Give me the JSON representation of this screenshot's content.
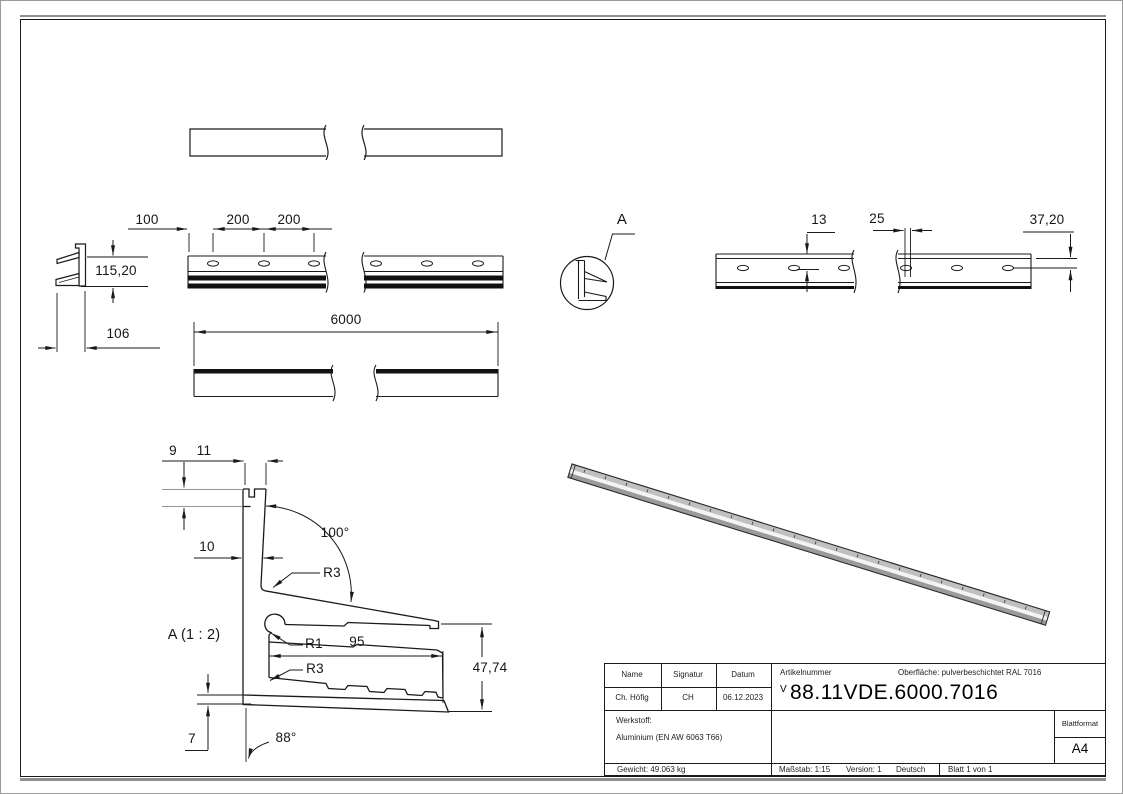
{
  "drawing": {
    "dims": {
      "d100": "100",
      "d200a": "200",
      "d200b": "200",
      "d115": "115,20",
      "d106": "106",
      "d6000": "6000",
      "d13": "13",
      "d25": "25",
      "d3720": "37,20",
      "d9": "9",
      "d11": "11",
      "d10": "10",
      "a100": "100°",
      "r3_upper": "R3",
      "r1": "R1",
      "d95": "95",
      "r3_lower": "R3",
      "d4774": "47,74",
      "d7": "7",
      "a88": "88°",
      "detail_label": "A",
      "detail_title": "A (1 : 2)"
    },
    "colors": {
      "line": "#1a1a1a",
      "extension_gray": "#949494",
      "shadow": "#8f8f8f",
      "bar3d_top": "#c0c0c0",
      "bar3d_mid": "#f4f4f4",
      "bar3d_bottom": "#9b9b9b"
    }
  },
  "title_block": {
    "name_label": "Name",
    "signatur_label": "Signatur",
    "datum_label": "Datum",
    "name_value": "Ch. Höfig",
    "signatur_value": "CH",
    "datum_value": "06.12.2023",
    "artikelnummer_label": "Artikelnummer",
    "oberflaeche": "Oberfläche:  pulverbeschichtet RAL 7016",
    "artikelnummer_prefix": "V",
    "artikelnummer_value": "88.11VDE.6000.7016",
    "werkstoff_label": "Werkstoff:",
    "werkstoff_value": "Aluminium (EN AW 6063 T66)",
    "blattformat_label": "Blattformat",
    "blattformat_value": "A4",
    "gewicht": "Gewicht: 49.063 kg",
    "massstab": "Maßstab: 1:15",
    "version": "Version: 1",
    "sprache": "Deutsch",
    "blatt": "Blatt 1 von 1"
  }
}
